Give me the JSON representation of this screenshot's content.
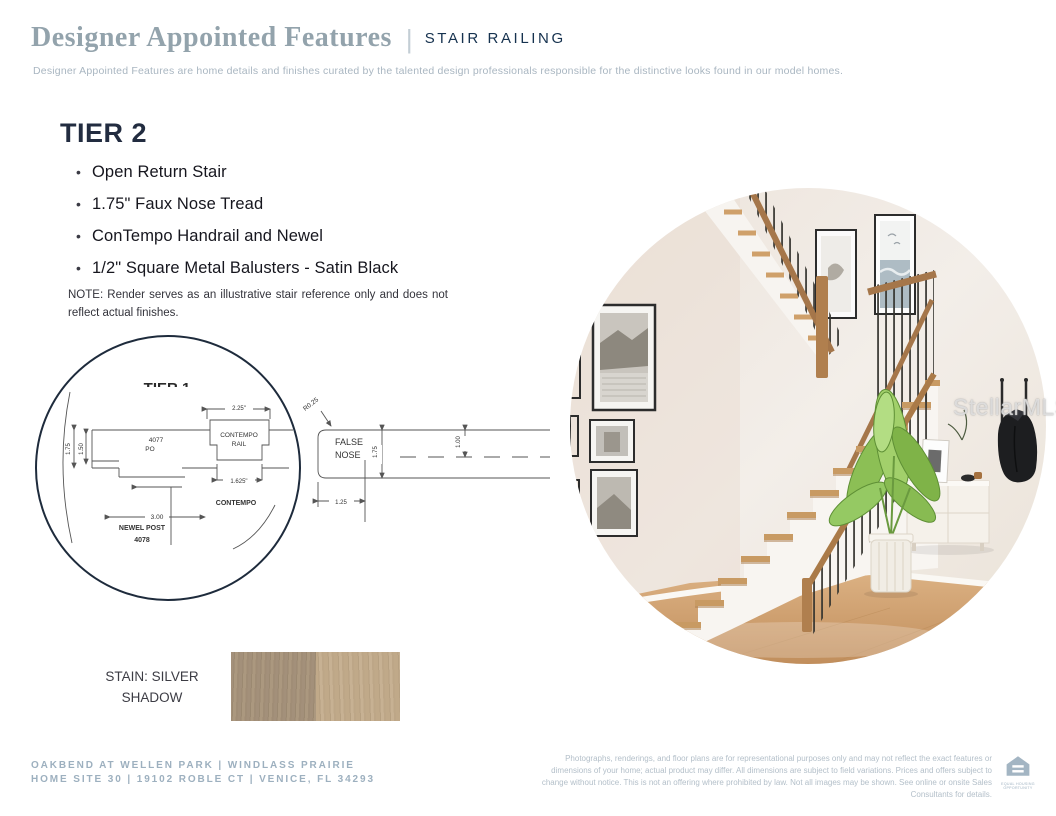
{
  "header": {
    "title": "Designer Appointed Features",
    "divider": "|",
    "category": "STAIR RAILING",
    "subtitle": "Designer Appointed Features are home details and finishes curated by the talented design professionals responsible for the distinctive looks found in our model homes."
  },
  "tier": {
    "heading": "TIER 2",
    "bullets": [
      "Open Return Stair",
      "1.75\" Faux Nose Tread",
      "ConTempo Handrail and Newel",
      "1/2\" Square Metal Balusters - Satin Black"
    ],
    "note": "NOTE: Render serves as an illustrative stair reference only and does not reflect actual finishes."
  },
  "diagram": {
    "tier_label": "TIER 1",
    "newel": {
      "dim_height": "1.75",
      "dim_inner": "1.50",
      "part_no": "4077",
      "part_suffix": "PO",
      "dim_width": "3.00",
      "caption_line1": "NEWEL POST",
      "caption_line2": "4078"
    },
    "rail": {
      "dim_top": "2.25\"",
      "label_line1": "CONTEMPO",
      "label_line2": "RAIL",
      "dim_bottom": "1.625\"",
      "caption": "CONTEMPO"
    },
    "nose": {
      "radius_label": "R0.25",
      "label_line1": "FALSE",
      "label_line2": "NOSE",
      "dim_height": "1.75",
      "dim_center": "1.00",
      "dim_depth": "1.25"
    }
  },
  "photo": {
    "watermark": "StellarMLS"
  },
  "stain": {
    "label": "STAIN: SILVER SHADOW",
    "left_color": "#a3907a",
    "right_color": "#c0a989"
  },
  "footer": {
    "community_line1": "OAKBEND AT WELLEN PARK | WINDLASS PRAIRIE",
    "community_line2": "HOME SITE 30 | 19102 ROBLE CT | VENICE, FL 34293",
    "disclaimer": "Photographs, renderings, and floor plans are for representational purposes only and may not reflect the exact features or dimensions of your home; actual product may differ. All dimensions are subject to field variations. Prices and offers subject to change without notice. This is not an offering where prohibited by law. Not all images may be shown. See online or onsite Sales Consultants for details.",
    "eho_line1": "EQUAL HOUSING",
    "eho_line2": "OPPORTUNITY"
  },
  "colors": {
    "accent_navy": "#16324f",
    "muted_blue_title": "#93a3ac",
    "footer_blue": "#9db0bf",
    "circle_border": "#1e2b3c"
  }
}
